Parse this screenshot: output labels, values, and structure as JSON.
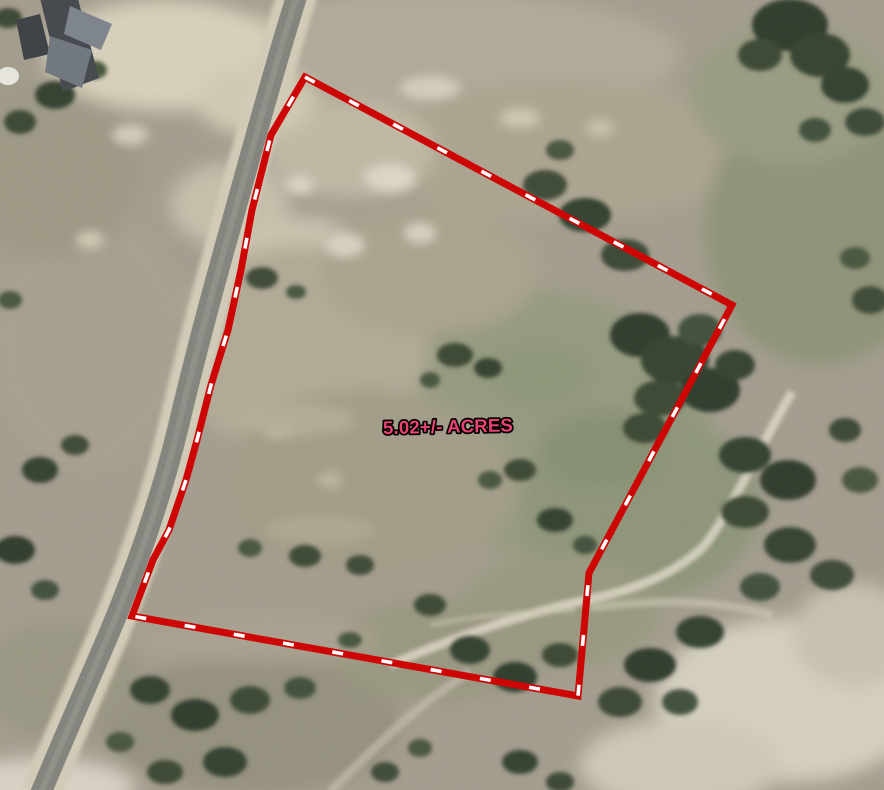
{
  "map": {
    "type": "aerial-parcel-map",
    "parcel": {
      "acreage_label": "5.02+/- ACRES",
      "boundary_points": "305,77 732,305 589,573 578,696 132,616 153,560 169,530 186,480 197,440 211,385 228,330 241,270 252,210 271,135"
    },
    "colors": {
      "boundary_line": "#ce0505",
      "boundary_dash": "#ffffff",
      "label_text": "#ea4370",
      "label_outline": "#000000"
    }
  }
}
